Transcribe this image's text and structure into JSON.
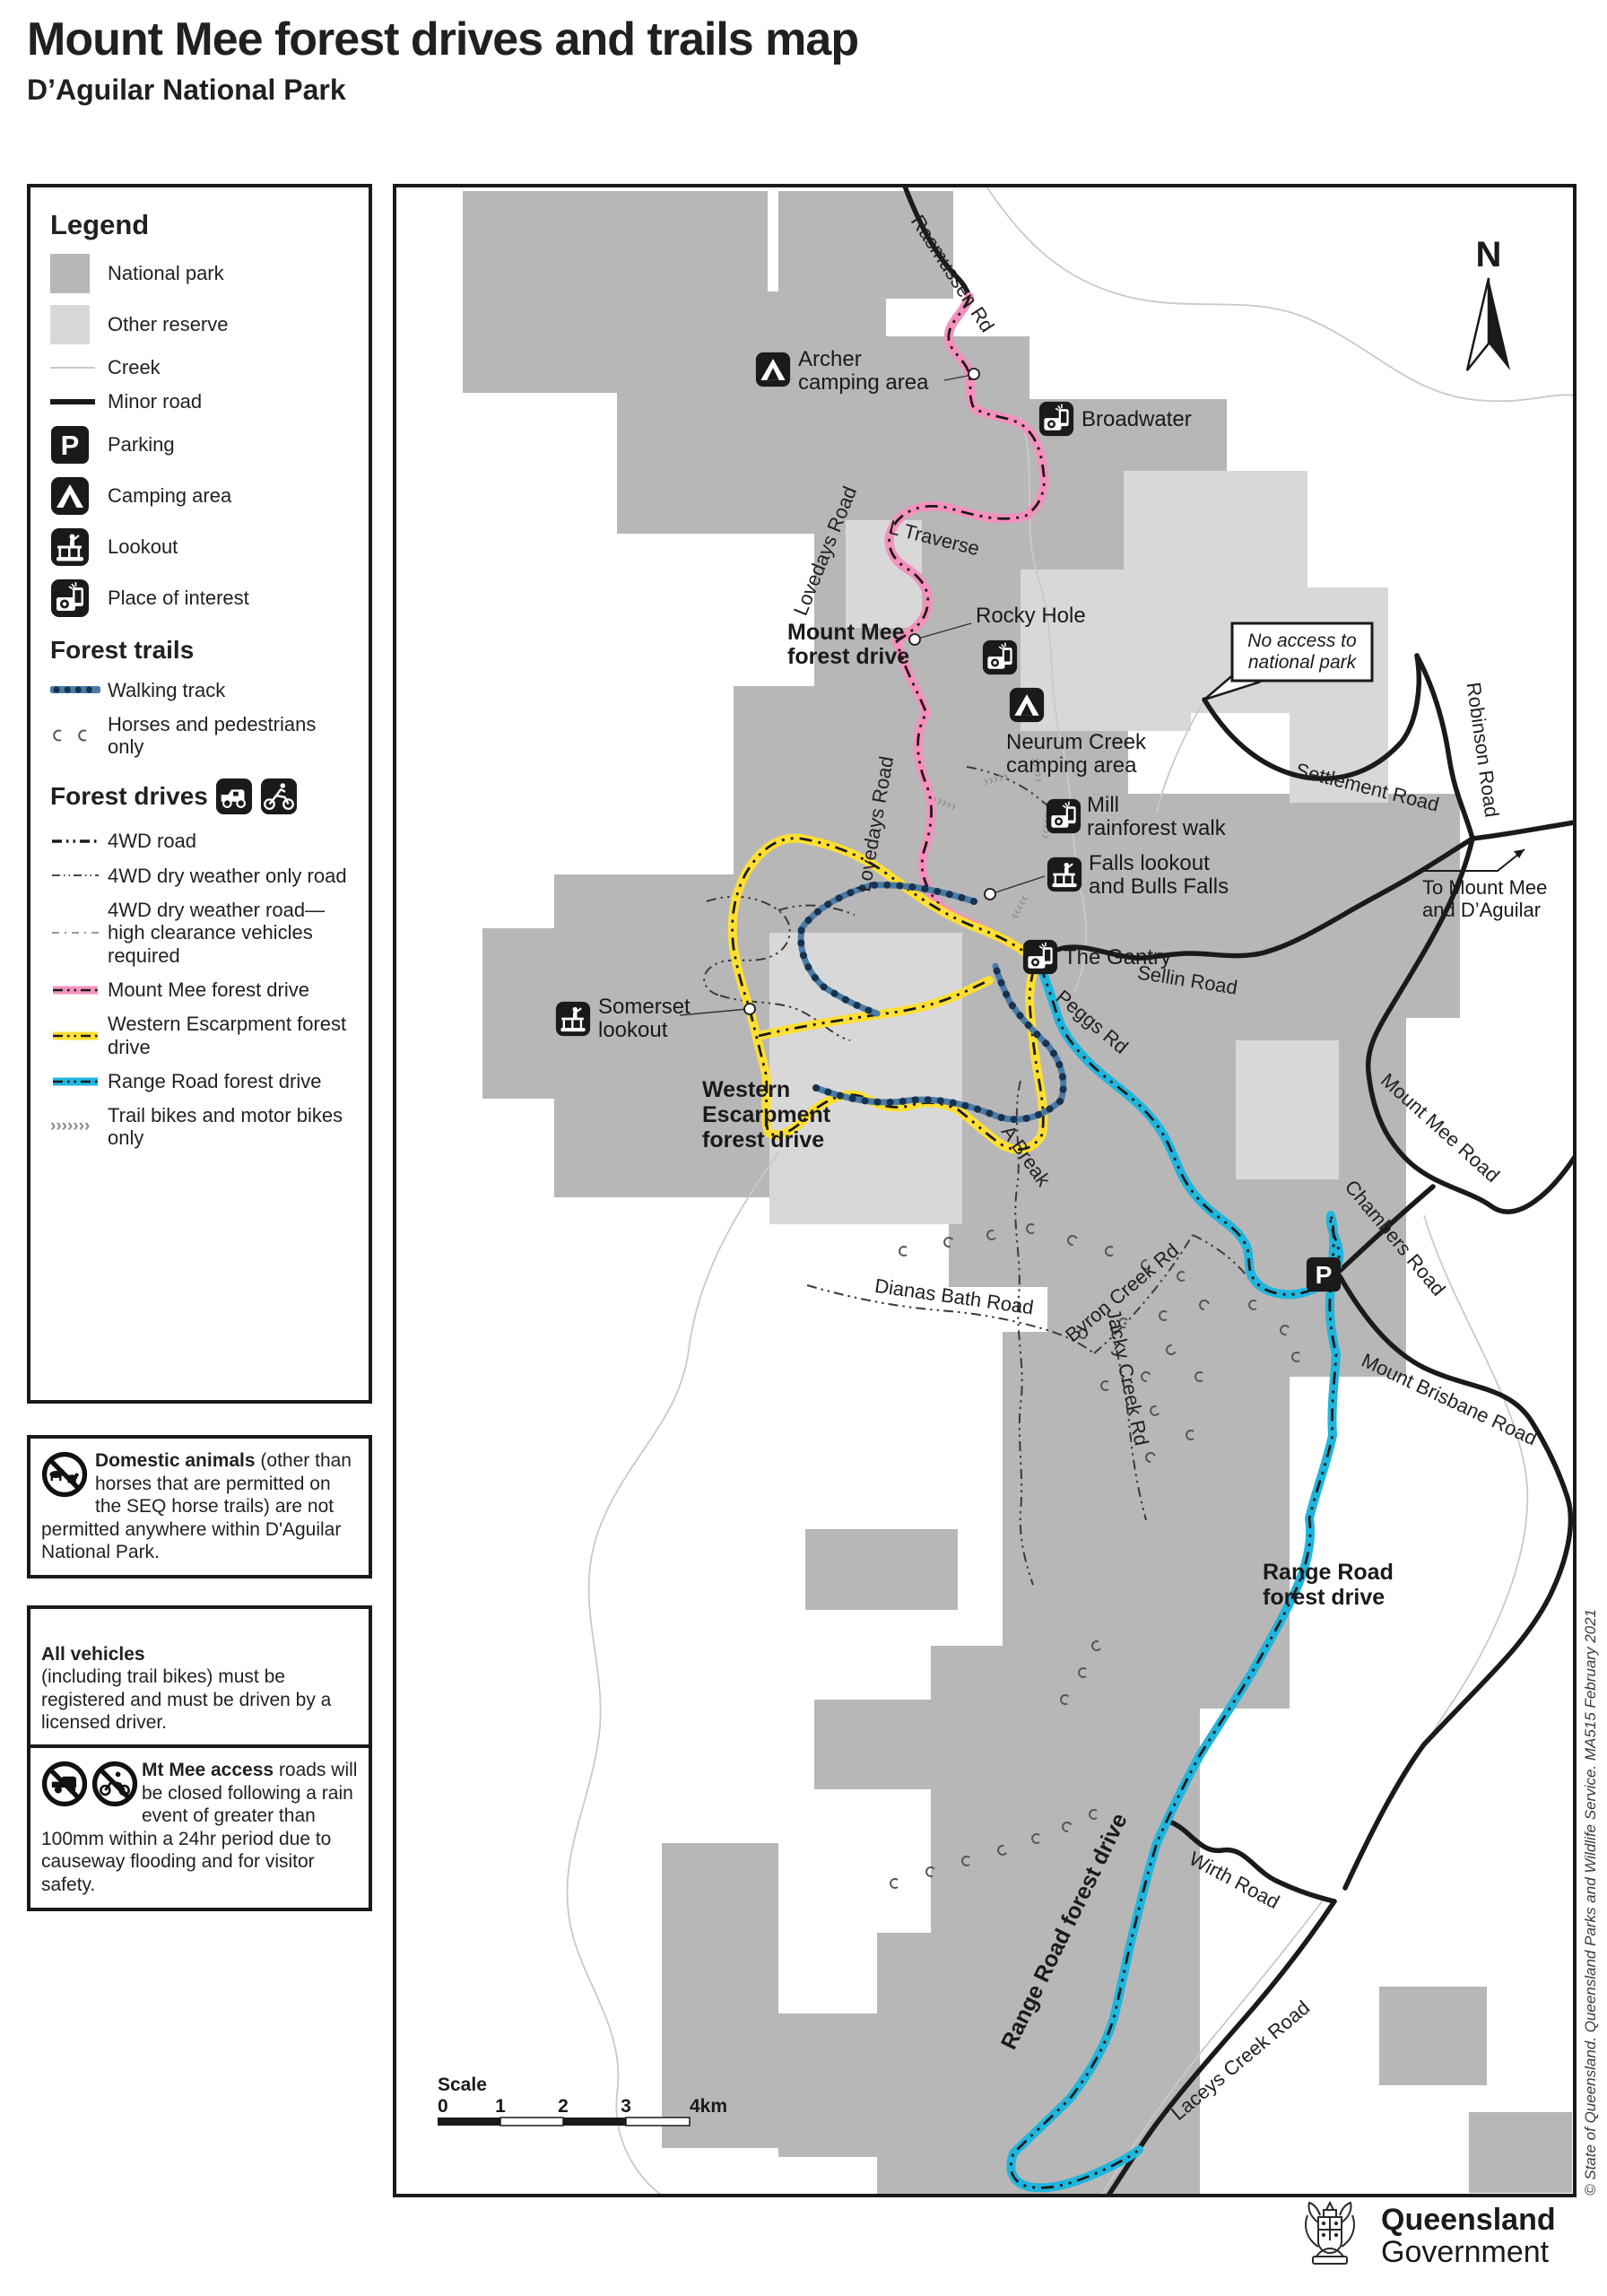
{
  "title": "Mount Mee forest drives and trails map",
  "subtitle": "D’Aguilar National Park",
  "legend": {
    "heading": "Legend",
    "items": [
      {
        "label": "National park"
      },
      {
        "label": "Other reserve"
      },
      {
        "label": "Creek"
      },
      {
        "label": "Minor road"
      },
      {
        "label": "Parking"
      },
      {
        "label": "Camping area"
      },
      {
        "label": "Lookout"
      },
      {
        "label": "Place of interest"
      }
    ],
    "trails_heading": "Forest trails",
    "trail_items": [
      {
        "label": "Walking track"
      },
      {
        "label": "Horses and pedestrians only"
      }
    ],
    "drives_heading": "Forest drives",
    "drive_items": [
      {
        "label": "4WD road"
      },
      {
        "label": "4WD dry weather only road"
      },
      {
        "label": "4WD dry weather road—high clearance vehicles required"
      },
      {
        "label": "Mount Mee forest drive"
      },
      {
        "label": "Western Escarpment forest drive"
      },
      {
        "label": "Range Road forest drive"
      },
      {
        "label": "Trail bikes and motor bikes only"
      }
    ]
  },
  "notes": [
    {
      "lead": "Domestic animals",
      "body": "(other than horses that are permitted on the SEQ horse trails) are not permitted anywhere within D'Aguilar National Park."
    },
    {
      "lead": "All vehicles",
      "body": "(including trail bikes) must be registered and must be driven by a licensed driver."
    },
    {
      "lead": "Mt Mee access",
      "body": "roads will be closed following a rain event of greater than 100mm within a 24hr period due to causeway flooding and for visitor safety."
    }
  ],
  "map": {
    "north": "N",
    "roads": {
      "rasmussen": "Rasmussen Rd",
      "lovedays_upper": "Lovedays Road",
      "lovedays_lower": "Lovedays Road",
      "l_traverse": "L Traverse",
      "settlement": "Settlement Road",
      "robinson": "Robinson Road",
      "sellin": "Sellin Road",
      "mount_mee": "Mount Mee Road",
      "chambers": "Chambers Road",
      "mount_brisbane": "Mount Brisbane Road",
      "peggs": "Peggs Rd",
      "a_break": "A Break",
      "dianas_bath": "Dianas Bath Road",
      "byron_creek": "Byron Creek Rd",
      "jacky_creek": "Jacky Creek Rd",
      "wirth": "Wirth Road",
      "laceys_creek": "Laceys Creek Road"
    },
    "poi": {
      "archer": [
        "Archer",
        "camping area"
      ],
      "broadwater": [
        "Broadwater"
      ],
      "rocky_hole": [
        "Rocky Hole"
      ],
      "neurum": [
        "Neurum Creek",
        "camping area"
      ],
      "mill": [
        "Mill",
        "rainforest walk"
      ],
      "falls": [
        "Falls lookout",
        "and Bulls Falls"
      ],
      "gantry": [
        "The Gantry"
      ],
      "somerset": [
        "Somerset",
        "lookout"
      ]
    },
    "drives": {
      "mount_mee": [
        "Mount Mee",
        "forest drive"
      ],
      "western": [
        "Western",
        "Escarpment",
        "forest drive"
      ],
      "range": [
        "Range Road",
        "forest drive"
      ],
      "range_route": "Range Road forest drive"
    },
    "callout": [
      "No access to",
      "national park"
    ],
    "to_mount_mee": [
      "To Mount Mee",
      "and D’Aguilar"
    ],
    "scale": {
      "heading": "Scale",
      "ticks": [
        "0",
        "1",
        "2",
        "3",
        "4km"
      ]
    }
  },
  "footer": {
    "copyright": "© State of Queensland. Queensland Parks and Wildlife Service. MA515 February 2021",
    "government": [
      "Queensland",
      "Government"
    ]
  },
  "colors": {
    "national_park": "#b7b7b7",
    "other_reserve": "#d8d8d8",
    "creek": "#c9c9c9",
    "road": "#1a1a1a",
    "mount_mee_drive": "#f491bd",
    "western_escarpment_drive": "#ffdf33",
    "range_road_drive": "#1fb6de",
    "walking_track": "#4a7ba6",
    "walking_track_dots": "#16324f"
  }
}
